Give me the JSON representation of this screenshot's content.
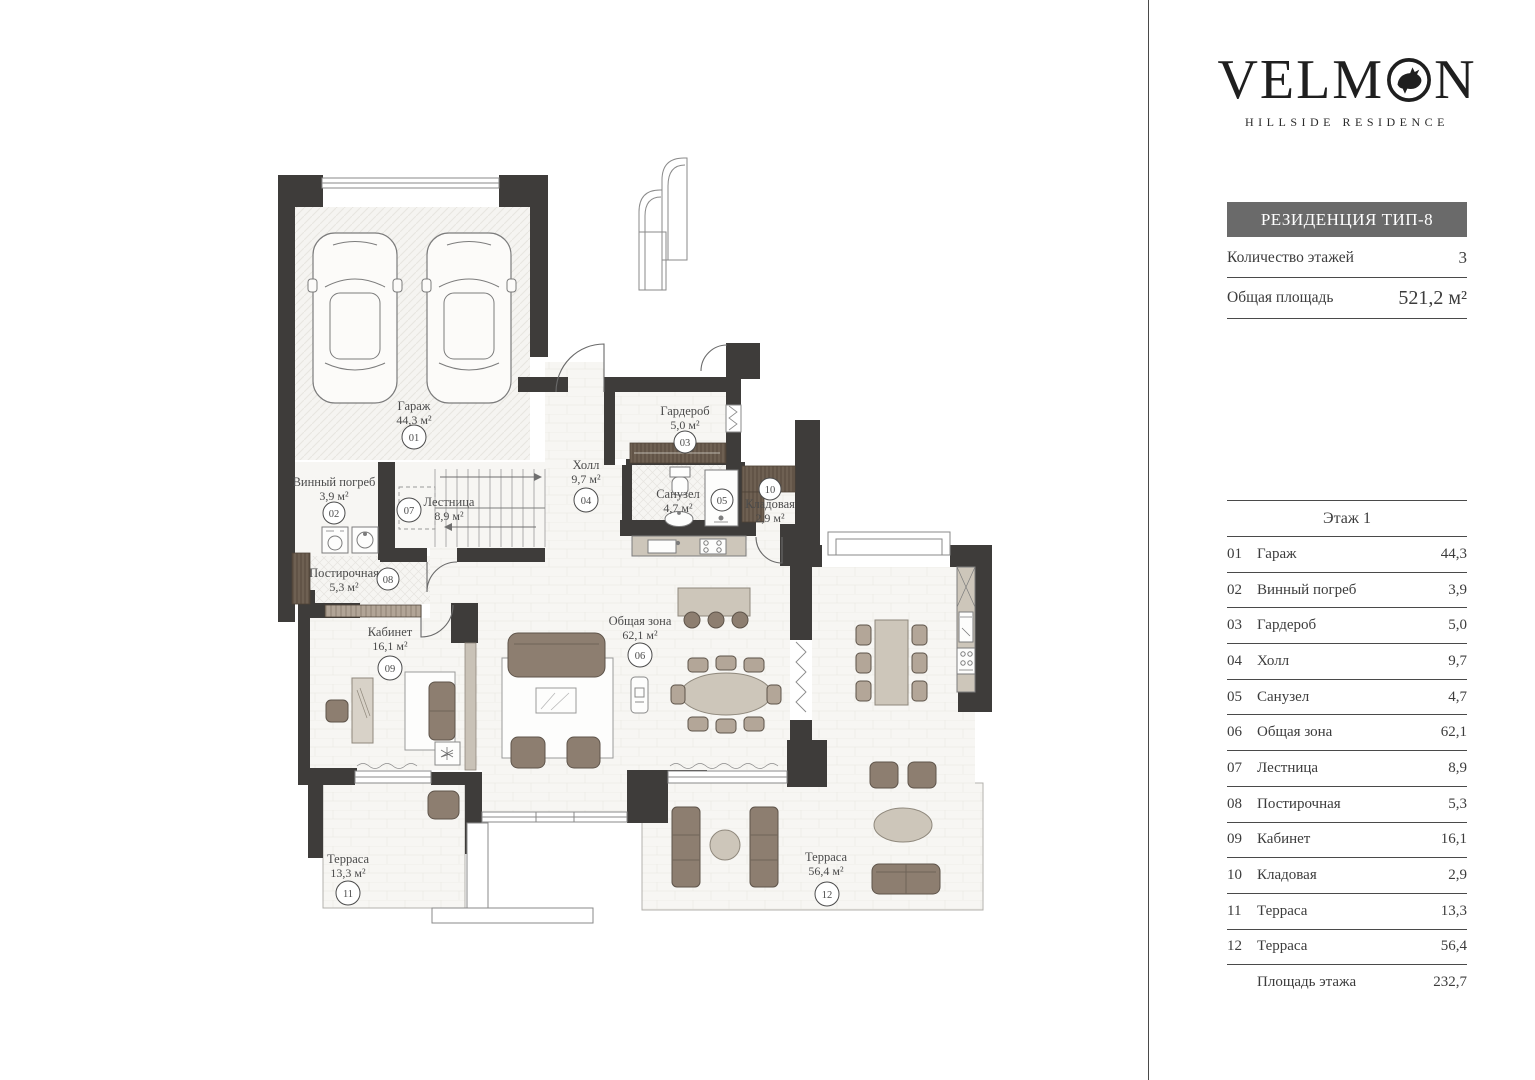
{
  "brand": {
    "logo_pre": "VELM",
    "logo_post": "N",
    "logo_bird_icon": "rooster-in-circle",
    "tagline": "HILLSIDE RESIDENCE"
  },
  "info": {
    "residence_type": "РЕЗИДЕНЦИЯ ТИП-8",
    "floors_label": "Количество этажей",
    "floors_value": "3",
    "area_label": "Общая площадь",
    "area_value": "521,2 м²"
  },
  "floor_table": {
    "title": "Этаж 1",
    "rows": [
      {
        "num": "01",
        "name": "Гараж",
        "area": "44,3"
      },
      {
        "num": "02",
        "name": "Винный погреб",
        "area": "3,9"
      },
      {
        "num": "03",
        "name": "Гардероб",
        "area": "5,0"
      },
      {
        "num": "04",
        "name": "Холл",
        "area": "9,7"
      },
      {
        "num": "05",
        "name": "Санузел",
        "area": "4,7"
      },
      {
        "num": "06",
        "name": "Общая зона",
        "area": "62,1"
      },
      {
        "num": "07",
        "name": "Лестница",
        "area": "8,9"
      },
      {
        "num": "08",
        "name": "Постирочная",
        "area": "5,3"
      },
      {
        "num": "09",
        "name": "Кабинет",
        "area": "16,1"
      },
      {
        "num": "10",
        "name": "Кладовая",
        "area": "2,9"
      },
      {
        "num": "11",
        "name": "Терраса",
        "area": "13,3"
      },
      {
        "num": "12",
        "name": "Терраса",
        "area": "56,4"
      }
    ],
    "total_label": "Площадь этажа",
    "total_value": "232,7"
  },
  "plan": {
    "rooms": [
      {
        "num": "01",
        "name": "Гараж",
        "area": "44,3 м²"
      },
      {
        "num": "02",
        "name": "Винный погреб",
        "area": "3,9 м²"
      },
      {
        "num": "03",
        "name": "Гардероб",
        "area": "5,0 м²"
      },
      {
        "num": "04",
        "name": "Холл",
        "area": "9,7 м²"
      },
      {
        "num": "05",
        "name": "Санузел",
        "area": "4,7 м²"
      },
      {
        "num": "06",
        "name": "Общая зона",
        "area": "62,1 м²"
      },
      {
        "num": "07",
        "name": "Лестница",
        "area": "8,9 м²"
      },
      {
        "num": "08",
        "name": "Постирочная",
        "area": "5,3 м²"
      },
      {
        "num": "09",
        "name": "Кабинет",
        "area": "16,1 м²"
      },
      {
        "num": "10",
        "name": "Кладовая",
        "area": "2,9 м²"
      },
      {
        "num": "11",
        "name": "Терраса",
        "area": "13,3 м²"
      },
      {
        "num": "12",
        "name": "Терраса",
        "area": "56,4 м²"
      }
    ]
  },
  "colors": {
    "wall": "#3e3c3a",
    "floor": "#f7f6f3",
    "furniture_brown": "#8d7e70",
    "furniture_light": "#cdc6ba",
    "closet_brown": "#6e6052",
    "banner_gray": "#6a6a6a",
    "text": "#3c3c3c"
  }
}
